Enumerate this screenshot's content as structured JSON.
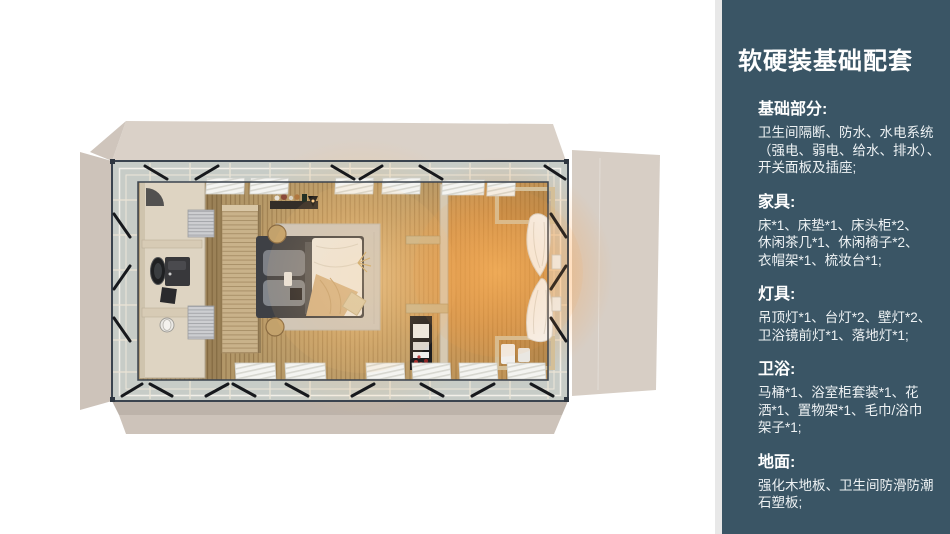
{
  "page": {
    "background": "#ffffff",
    "width": 950,
    "height": 534
  },
  "room_render": {
    "view": "top-down 3D render of a prefab guest suite",
    "objects": [
      "building-shell",
      "glass-perimeter-wall",
      "steel-frame",
      "cross-braces",
      "curtain-blinds",
      "wood-plank-floor",
      "bathroom",
      "shower",
      "vanity-mirror",
      "toilet",
      "towel-radiators",
      "headboard-wall",
      "double-bed",
      "pillows",
      "duvet",
      "throw-blanket",
      "area-rug",
      "nightstands",
      "wall-shelf-with-bottles",
      "wall-lamp",
      "partition-wall",
      "display-shelves",
      "storage-cabinet",
      "lounge-niches",
      "sheer-curtains",
      "warm-lamp-glow"
    ],
    "palette": {
      "shell_beige": "#d6cdc4",
      "glass": "#c7ccc7",
      "frame_steel": "#3a434e",
      "floor_wood": "#b29768",
      "warm_glow": "#ffb257",
      "bathroom_stone": "#ded4c2",
      "bed_duvet": "#edeae4",
      "bed_frame": "#3e4045",
      "rug": "#ccc7bf"
    }
  },
  "sidebar": {
    "background": "#3a5565",
    "left_edge": "#e8e8e8",
    "text_color": "#eef2f4",
    "title": "软硬装基础配套",
    "sections": [
      {
        "heading": "基础部分:",
        "lines": [
          "卫生间隔断、防水、水电系统",
          "（强电、弱电、给水、排水）、",
          "开关面板及插座;"
        ]
      },
      {
        "heading": "家具:",
        "lines": [
          "床*1、床垫*1、床头柜*2、",
          "休闲茶几*1、休闲椅子*2、",
          "衣帽架*1、梳妆台*1;"
        ]
      },
      {
        "heading": "灯具:",
        "lines": [
          "吊顶灯*1、台灯*2、壁灯*2、",
          "卫浴镜前灯*1、落地灯*1;"
        ]
      },
      {
        "heading": "卫浴:",
        "lines": [
          "马桶*1、浴室柜套装*1、花",
          "洒*1、置物架*1、毛巾/浴巾",
          "架子*1;"
        ]
      },
      {
        "heading": "地面:",
        "lines": [
          "强化木地板、卫生间防滑防潮",
          "石塑板;"
        ]
      }
    ]
  }
}
